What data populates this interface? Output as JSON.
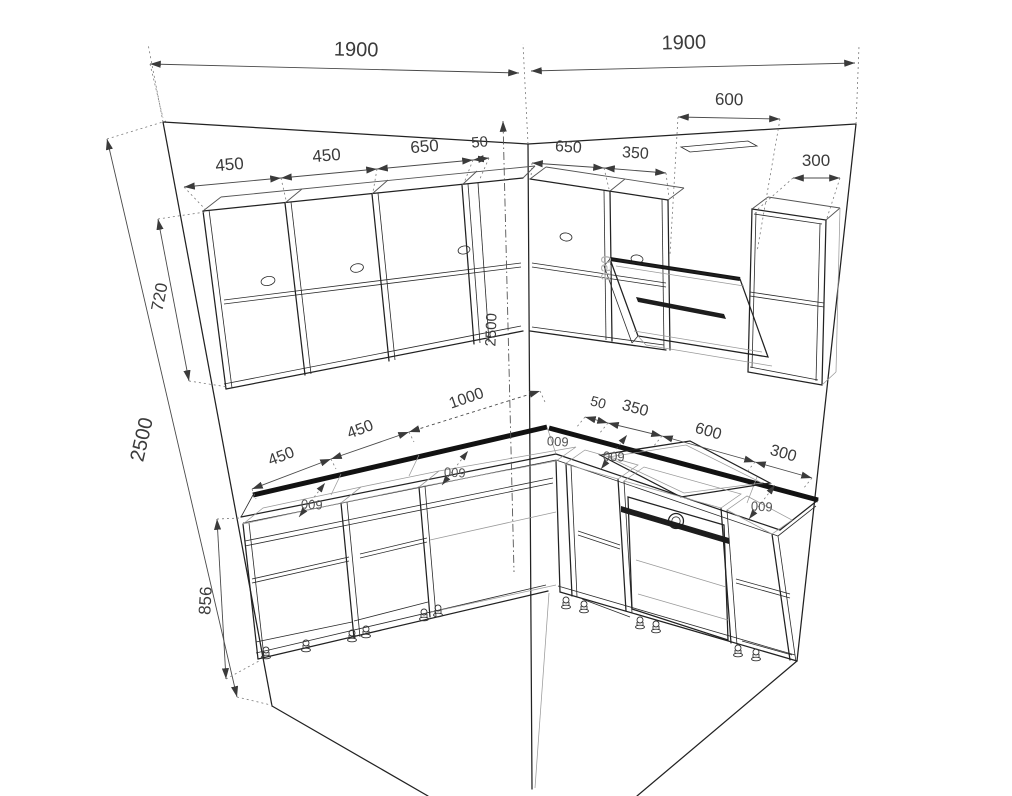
{
  "drawing": {
    "type": "kitchen-corner-perspective-drawing",
    "units": "mm",
    "line_color": "#222222",
    "accent_color": "#121212",
    "text_color": "#3b3b3b"
  },
  "walls": {
    "left_width_label": "1900",
    "right_width_label": "1900",
    "height_label": "2500",
    "corner_height_label": "2500"
  },
  "upper_cabinets": {
    "height_label": "720",
    "left_widths": [
      "450",
      "450",
      "650",
      "50"
    ],
    "right_widths": [
      "650",
      "350",
      "300"
    ],
    "hood_width_label": "600",
    "hood_clearance_label": "950"
  },
  "base_cabinets": {
    "height_label": "856",
    "left_widths": [
      "450",
      "450",
      "1000"
    ],
    "right_widths": [
      "50",
      "350",
      "600",
      "300"
    ],
    "depth_label": "600"
  }
}
